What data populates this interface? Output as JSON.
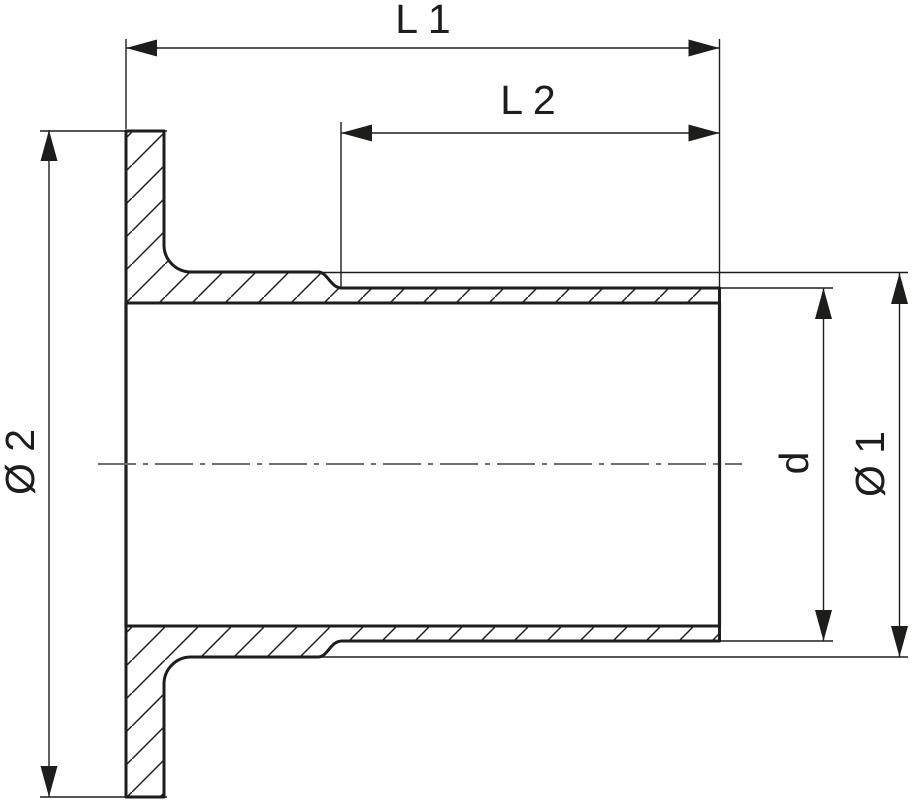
{
  "drawing": {
    "description": "cross-section technical drawing of a flanged pipe adapter",
    "background_color": "#ffffff",
    "line_color": "#1d1d1b",
    "centerline_color": "#6e6e6e",
    "dimensions": {
      "total_length": {
        "label": "L 1"
      },
      "plain_end_length": {
        "label": "L 2"
      },
      "flange_outer_diameter": {
        "label": "Ø 2"
      },
      "collar_outer_diameter": {
        "label": "Ø 1"
      },
      "pipe_outer_diameter": {
        "label": "d"
      }
    }
  }
}
